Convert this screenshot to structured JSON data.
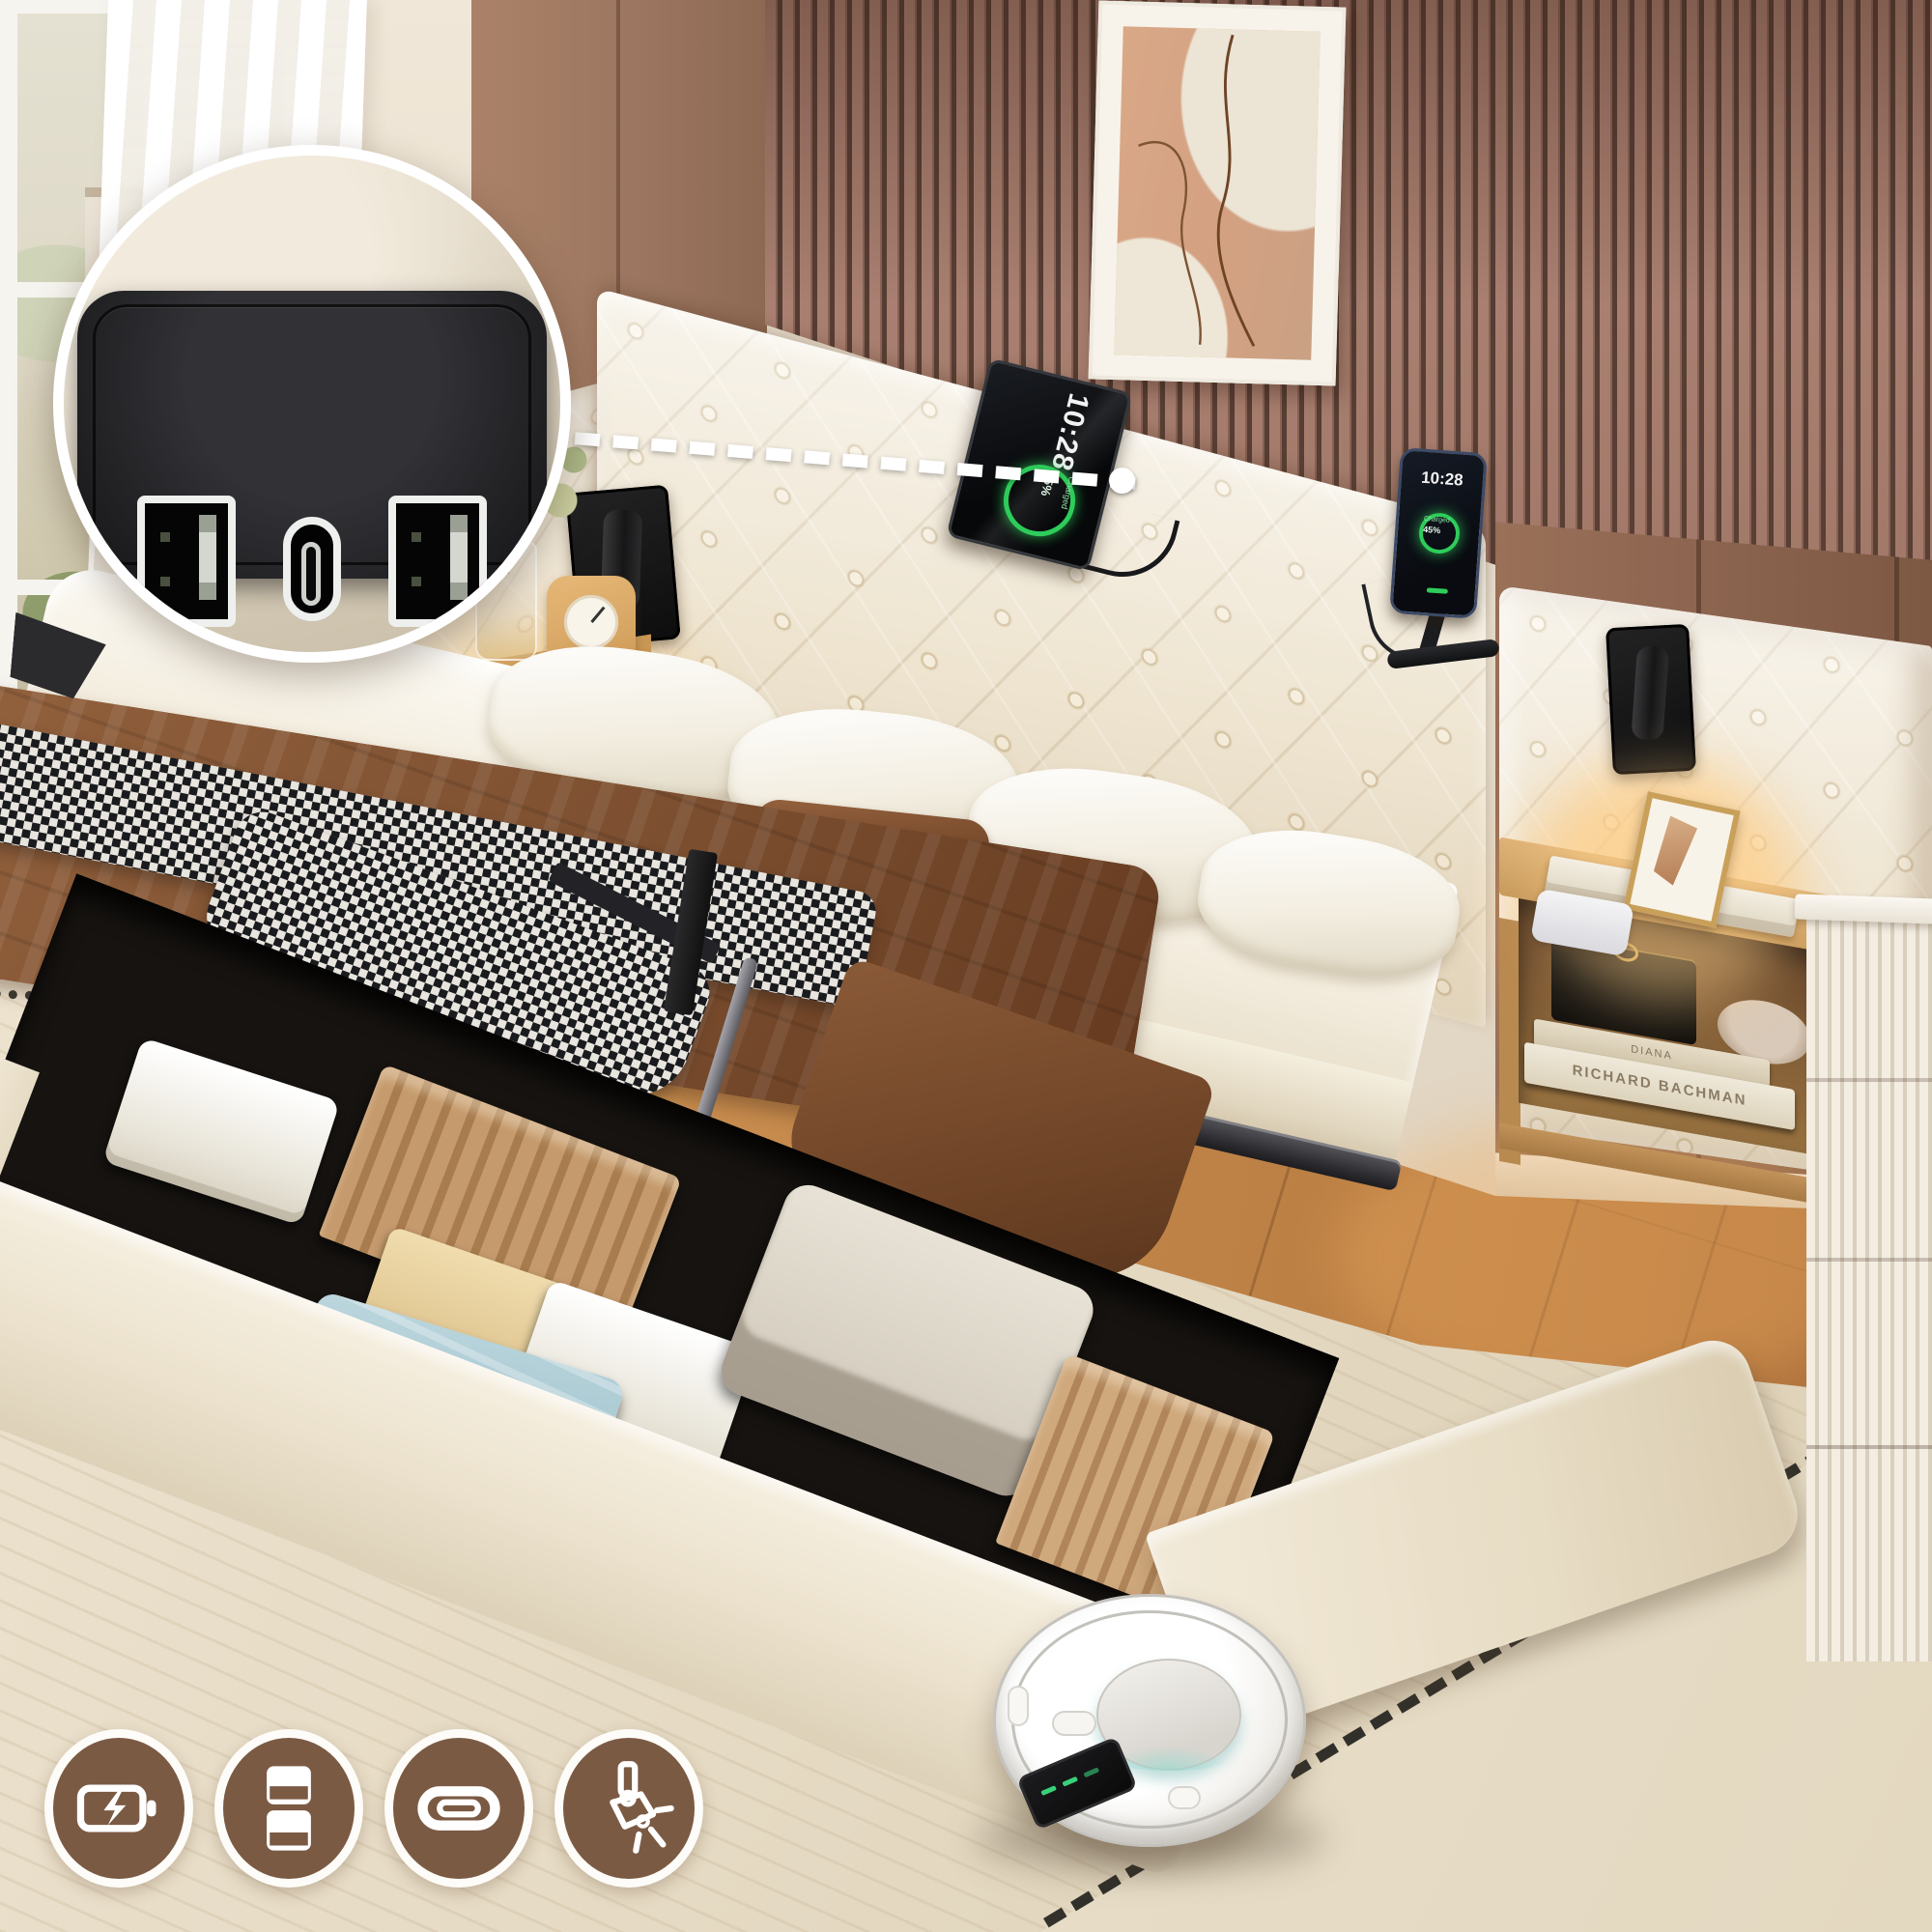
{
  "scene": {
    "type": "product lifestyle photo",
    "subject": "Upholstered queen storage bed with hydraulic lift-up frame, button-tufted wingback headboard, built-in USB charging station and recessed reading spotlights",
    "room": "bedroom with wood slat accent wall, framed abstract art, window with sheer curtains, wood plank floor, beige rug and robot vacuum"
  },
  "inset_detail": {
    "name": "charging-hub-closeup",
    "ports": [
      "USB-A",
      "USB-C",
      "USB-A"
    ]
  },
  "devices": {
    "tablet": {
      "time": "10:28",
      "battery": "45%",
      "status": "Charged"
    },
    "phone": {
      "time": "10:28",
      "battery": "45%",
      "status": "Charged"
    }
  },
  "books": [
    {
      "spine": "DIANA"
    },
    {
      "spine": "RICHARD BACHMAN"
    }
  ],
  "feature_icons": [
    {
      "name": "battery-charging-icon",
      "meaning": "charging"
    },
    {
      "name": "dual-usb-ports-icon",
      "meaning": "dual USB-A ports"
    },
    {
      "name": "usb-c-port-icon",
      "meaning": "USB-C port"
    },
    {
      "name": "spotlight-icon",
      "meaning": "reading spotlights"
    }
  ],
  "colors": {
    "icon_badge": "#7b5a44",
    "headboard": "#f1e9d8",
    "wall_wood": "#9c7660",
    "wall_slat_dark": "#553d33",
    "wall_slat_light": "#a87f70",
    "floor": "#c78c4e",
    "rug": "#e7dcc6",
    "blanket": "#7c4f30",
    "charge_ring": "#2ecc5a",
    "suitcase": "#a3c5cf"
  }
}
